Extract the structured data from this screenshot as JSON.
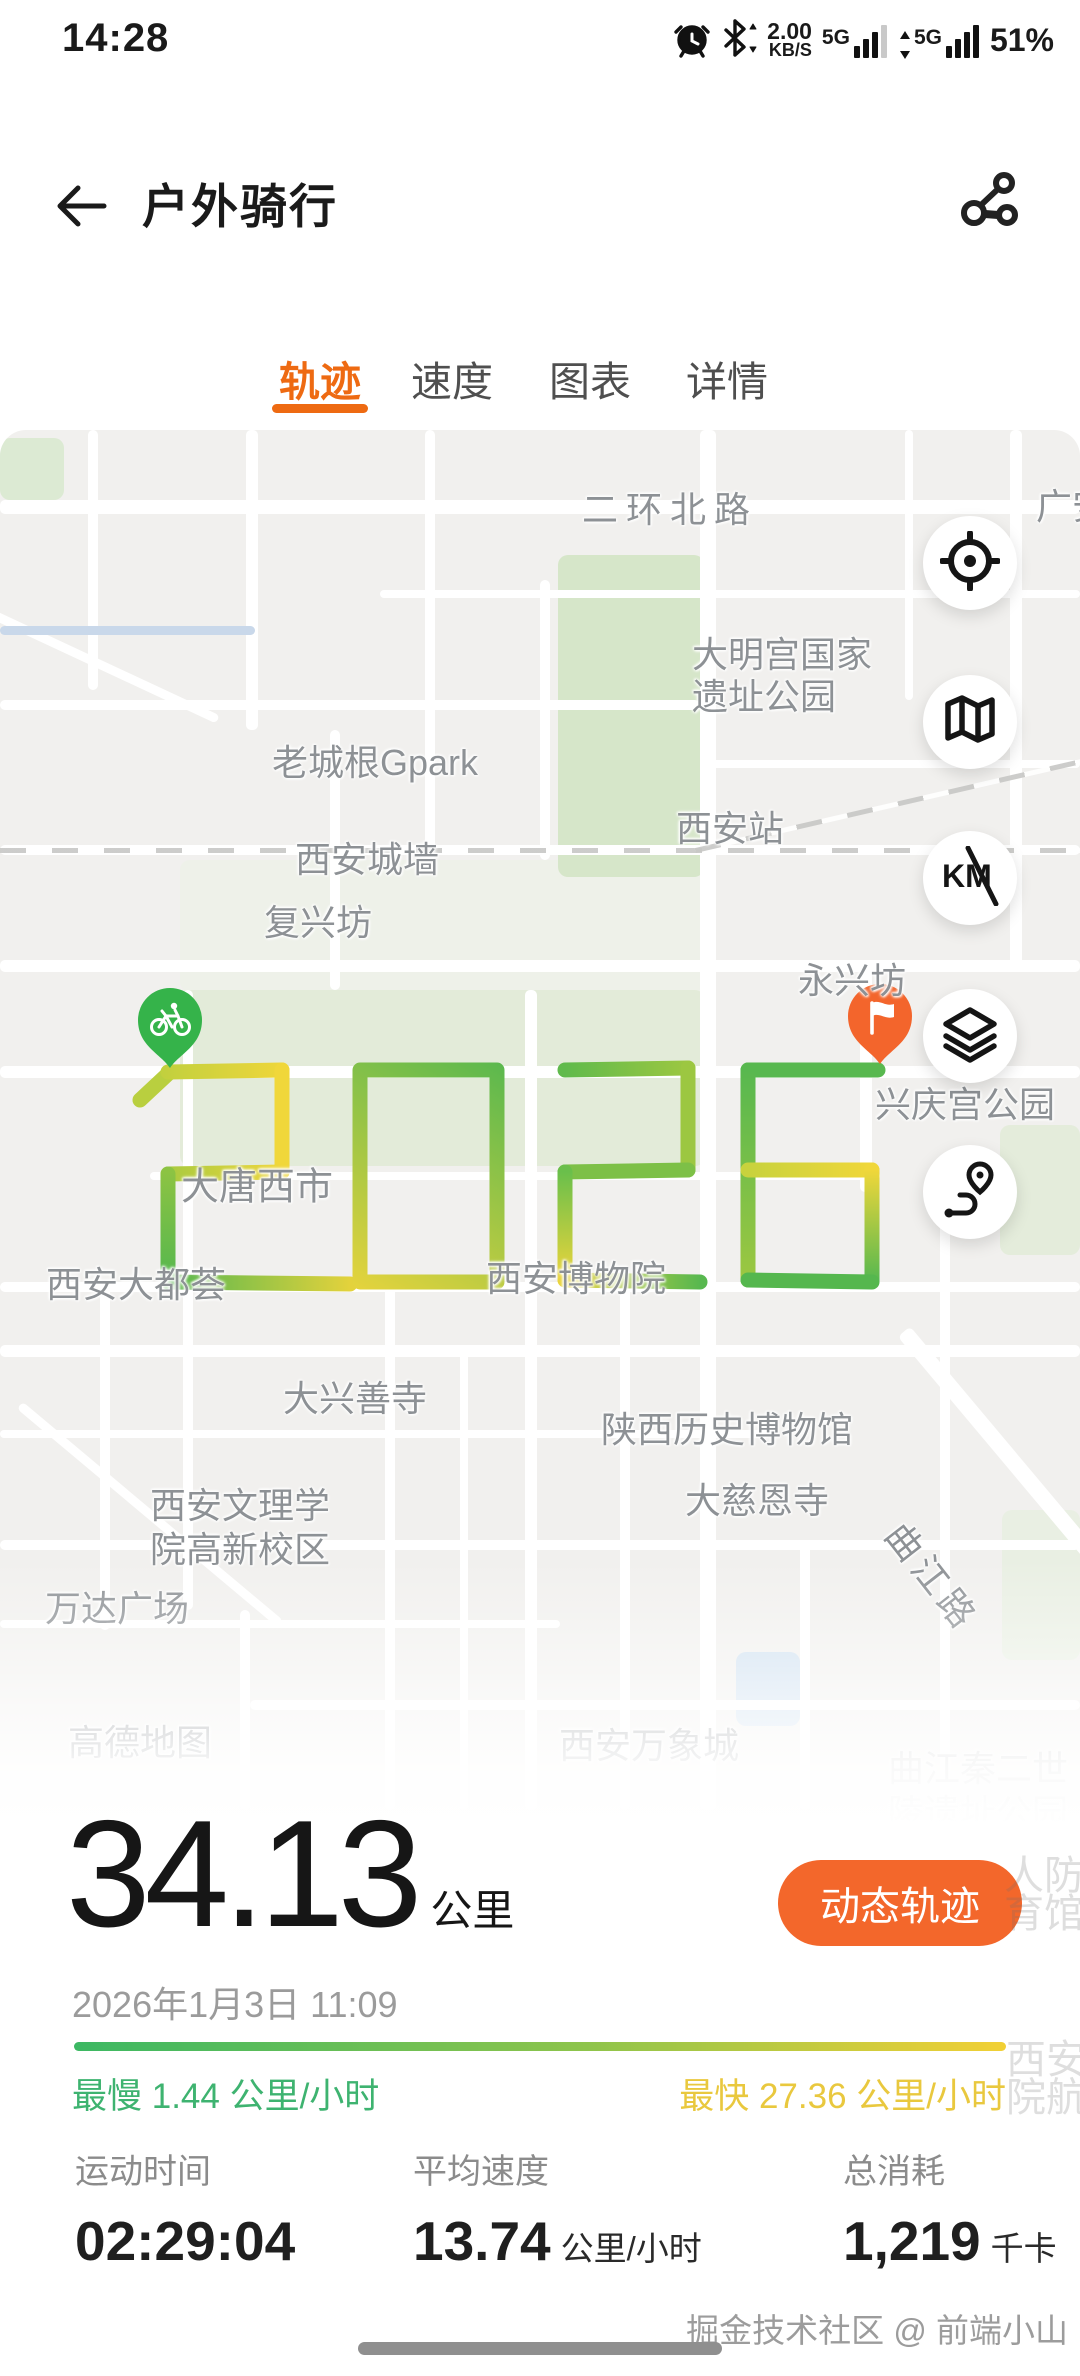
{
  "colors": {
    "accent_orange": "#ee6a12",
    "button_orange": "#f3672b",
    "route_green": "#58b84f",
    "route_yellow": "#f0d73a",
    "slow_green": "#3eb370",
    "fast_yellow": "#e9c83e",
    "start_pin": "#35b34a",
    "end_pin": "#f3652c"
  },
  "status_bar": {
    "time": "14:28",
    "icons": [
      "alarm-icon",
      "bluetooth-icon",
      "signal-bars-icon",
      "signal-bars-icon"
    ],
    "net_speed_value": "2.00",
    "net_speed_unit": "KB/S",
    "sim1_label": "5G",
    "sim2_label": "5G",
    "battery": "51%"
  },
  "header": {
    "title": "户外骑行",
    "back_icon": "back-arrow-icon",
    "share_icon": "share-route-icon"
  },
  "tabs": [
    {
      "label": "轨迹",
      "active": true
    },
    {
      "label": "速度",
      "active": false
    },
    {
      "label": "图表",
      "active": false
    },
    {
      "label": "详情",
      "active": false
    }
  ],
  "map": {
    "provider": "高德地图",
    "buttons": [
      "locate-icon",
      "map-mode-icon",
      "km-marker-toggle-icon",
      "layers-icon",
      "route-overview-icon"
    ],
    "start_marker": "bike-start-pin",
    "end_marker": "finish-flag-pin",
    "route_text": "2026",
    "labels": [
      {
        "t": "二环北路",
        "x": 670,
        "y": 77,
        "ls": 8
      },
      {
        "t": "广安",
        "x": 1072,
        "y": 74
      },
      {
        "t": "大明宫国家",
        "x": 782,
        "y": 222
      },
      {
        "t": "遗址公园",
        "x": 764,
        "y": 264
      },
      {
        "t": "老城根Gpark",
        "x": 375,
        "y": 330
      },
      {
        "t": "西安站",
        "x": 730,
        "y": 396
      },
      {
        "t": "西安城墙",
        "x": 367,
        "y": 427
      },
      {
        "t": "复兴坊",
        "x": 318,
        "y": 490
      },
      {
        "t": "永兴坊",
        "x": 852,
        "y": 548
      },
      {
        "t": "兴庆宫公园",
        "x": 965,
        "y": 672
      },
      {
        "t": "大唐西市",
        "x": 257,
        "y": 753,
        "fs": 38
      },
      {
        "t": "西安大都荟",
        "x": 136,
        "y": 852
      },
      {
        "t": "西安博物院",
        "x": 576,
        "y": 846
      },
      {
        "t": "大兴善寺",
        "x": 355,
        "y": 966
      },
      {
        "t": "陕西历史博物馆",
        "x": 727,
        "y": 997
      },
      {
        "t": "大慈恩寺",
        "x": 757,
        "y": 1068
      },
      {
        "t": "西安文理学",
        "x": 240,
        "y": 1073
      },
      {
        "t": "院高新校区",
        "x": 240,
        "y": 1117
      },
      {
        "t": "曲江路",
        "x": 934,
        "y": 1146,
        "rot": 52,
        "ls": 6
      },
      {
        "t": "万达广场",
        "x": 117,
        "y": 1176
      },
      {
        "t": "高德地图",
        "x": 140,
        "y": 1310
      },
      {
        "t": "西安万象城",
        "x": 649,
        "y": 1313,
        "op": 0.85
      },
      {
        "t": "曲江秦二世",
        "x": 978,
        "y": 1336,
        "op": 0.5
      },
      {
        "t": "陵遗址公园",
        "x": 978,
        "y": 1380,
        "op": 0.5
      }
    ],
    "faint_labels": [
      {
        "t": "人防",
        "x": 1044,
        "y": 1872
      },
      {
        "t": "育馆",
        "x": 1044,
        "y": 1910
      },
      {
        "t": "西安",
        "x": 1046,
        "y": 2056
      },
      {
        "t": "院航",
        "x": 1046,
        "y": 2094
      }
    ]
  },
  "summary": {
    "distance": "34.13",
    "distance_unit": "公里",
    "dynamic_button_label": "动态轨迹",
    "datetime": "2026年1月3日 11:09",
    "slowest": "最慢 1.44 公里/小时",
    "fastest": "最快 27.36 公里/小时"
  },
  "metrics": [
    {
      "label": "运动时间",
      "value": "02:29:04",
      "unit": ""
    },
    {
      "label": "平均速度",
      "value": "13.74",
      "unit": "公里/小时"
    },
    {
      "label": "总消耗",
      "value": "1,219",
      "unit": "千卡"
    }
  ],
  "footer": {
    "credit": "掘金技术社区 @ 前端小山"
  }
}
